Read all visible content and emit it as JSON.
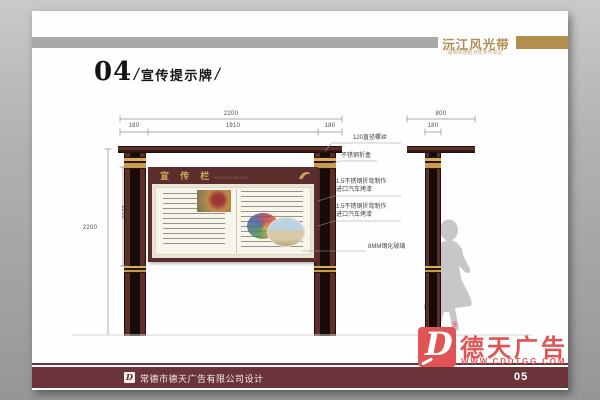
{
  "brand": {
    "title": "沅江风光带",
    "subtitle": "湖南常德经济技术开发区"
  },
  "page_title": {
    "number": "04",
    "separator": "/",
    "name": "宣传提示牌"
  },
  "front_view": {
    "dim_total_width": "2200",
    "dim_seg_left": "180",
    "dim_seg_center": "1910",
    "dim_seg_right": "180",
    "dim_total_height": "2200",
    "dim_board_height": "1160",
    "board_title_cn": "宣 传 栏",
    "board_title_en": "NOTIFICATION"
  },
  "side_view": {
    "dim_width": "800",
    "dim_post": "180"
  },
  "callouts": {
    "screw": "120直径螺丝",
    "box": "不锈钢折盒",
    "steel1_line1": "1.5不锈钢折弯制作",
    "steel1_line2": "进口汽车烤漆",
    "steel2_line1": "1.5不锈钢折弯制作",
    "steel2_line2": "进口汽车烤漆",
    "glass": "8MM钢化玻璃"
  },
  "watermark": {
    "registered": "®",
    "logo_letter": "D",
    "brand_name": "德天广告",
    "website": "WWW.CDDTGG.COM"
  },
  "footer": {
    "logo_letter": "D",
    "company": "常德市德天广告有限公司设计",
    "page_number": "05"
  },
  "colors": {
    "maroon": "#5d2f2b",
    "gold": "#b3914e",
    "red": "#e15454",
    "cream": "#e9e4d4",
    "silhouette": "#c7c7c7"
  }
}
